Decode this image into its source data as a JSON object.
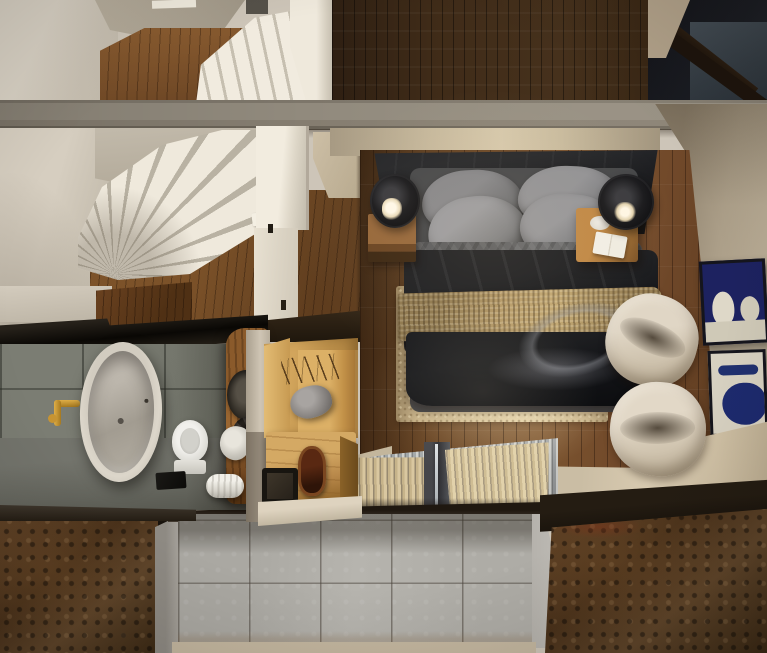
{
  "meta": {
    "type": "3d-interior-render",
    "view": "top-down cutaway of a loft apartment",
    "description": "Overhead architectural render: winder staircase and landing at top left, dark timber upper floor and stairwell void at top right, mezzanine bedroom with double bed, nightstands, black pendant lamps, beige rug, two cream lounge chairs and abstract wall art on the right, bathroom with freestanding oval tub, brass filler, toilet and live-edge stone-basin vanity at lower left, oak wardrobe unit in the centre, and a lower level seen past corrugated skylight panels, a grey tiled wall and rusted roof sheets at the bottom."
  },
  "colors": {
    "wall-cream": "#cdc5b8",
    "wall-light": "#eee8db",
    "wall-taupe": "#aaa292",
    "beam-grey": "#8b8478",
    "stair-tread": "#efe9dc",
    "stair-riser": "#b9b2a3",
    "loft-wood": "#3b2917",
    "bedroom-wood": "#6b4726",
    "hall-wood": "#7c5229",
    "oak": "#c79e5e",
    "headboard": "#1b1c1e",
    "pillow-grey": "#8b8b8d",
    "sheet-grey": "#5c5d5f",
    "duvet-black": "#101113",
    "throw-tan": "#b59a68",
    "rug-beige": "#c9b58d",
    "lamp-black": "#151517",
    "chair-cream": "#d8cebd",
    "art-navy": "#1d2260",
    "art-cream": "#d7d1c1",
    "bath-tile": "#787a70",
    "tub-cream": "#d5cfc3",
    "brass": "#c6922f",
    "lower-tile": "#b2b0aa",
    "rust-brown": "#4e3620",
    "void-dark": "#15161b",
    "steel-blue": "#3a434b",
    "concrete-beige": "#cfc2a8"
  },
  "scene": {
    "staircase": {
      "landing": "Timber stair landing",
      "upper_flight": "Upper stair flight",
      "winder": "Winder staircase",
      "side_wall": "Staircase side wall",
      "hall_wall": "Stair hall wall",
      "pillar": "Stair wall with door",
      "hall_floor": "Oak hall floor",
      "handrail": "Handrail bracket"
    },
    "structure": {
      "beam": "Concrete edge beam",
      "void": "Double-height stairwell void",
      "loft_floor": "Dark timber upper floor",
      "wall_wedge": "Plaster wall wedge"
    },
    "bedroom": {
      "far_wall": "Bedroom back wall",
      "side_wall": "Bedroom side wall",
      "floor": "Oak bedroom floor",
      "headboard": "Upholstered headboard",
      "pillows": "Grey pillows",
      "sheet": "Grey top sheet",
      "duvet": "Black duvet",
      "throw": "Chunky knit throw",
      "rug": "Distressed beige rug",
      "nightstand_left": "Left oak nightstand",
      "nightstand_right": "Right oak nightstand",
      "lamp_left": "Black cylinder pendant lamp",
      "lamp_right": "Black cylinder pendant lamp",
      "tray": "White tray",
      "book": "Open book",
      "chair_back": "Cream lounge chair",
      "chair_front": "Cream lounge chair",
      "art_top": "Navy abstract artwork",
      "art_bottom": "Cream abstract artwork"
    },
    "bathroom": {
      "tiles": "Grey tiled bathroom wall",
      "floor": "Bathroom stone floor",
      "edge": "Floor slab edge",
      "tub": "Freestanding oval bathtub",
      "faucet": "Brass wall-mounted tub filler",
      "toilet": "Toilet",
      "vanity": "Live-edge timber vanity",
      "basin_upper": "Stone vessel basin",
      "basin_lower": "Carved stone basin",
      "towel": "Folded towel",
      "towel_roll": "Rolled towel",
      "mat": "Black bath mat",
      "glass": "Smoked-glass partition",
      "wall_band": "Plaster wall band",
      "wood_top": "Timber floor edge"
    },
    "wardrobe": {
      "unit": "Oak wardrobe unit",
      "door": "Oak wardrobe door",
      "bench": "Oak bench cabinet",
      "bench_face": "Bench front face",
      "garment": "Hanging grey garment",
      "branch": "Dried branch decor",
      "mirror": "Timber-framed mirror",
      "stool": "Black stool",
      "ledge": "Plaster ledge",
      "wall_sliver": "Partition wall"
    },
    "lower_level": {
      "threshold": "Floor threshold",
      "skylight": "Corrugated skylight panels",
      "mat_left": "Woven runner mat",
      "mat_right": "Woven runner mat",
      "beam": "Steel skylight beam",
      "beam_shadow": "Skylight support shadow",
      "band": "Polished concrete walkway",
      "tiles": "Grey tiled wall of lower level",
      "tile_edge": "Wall top edge",
      "wall_left": "Concrete flank wall",
      "wall_right": "Concrete flank wall",
      "roof_left": "Rusted roof panel",
      "roof_right": "Rusted roof panel",
      "shadow_left": "Roof shadow",
      "shadow_right": "Roof shadow",
      "floor_strip": "Lower level floor"
    }
  }
}
